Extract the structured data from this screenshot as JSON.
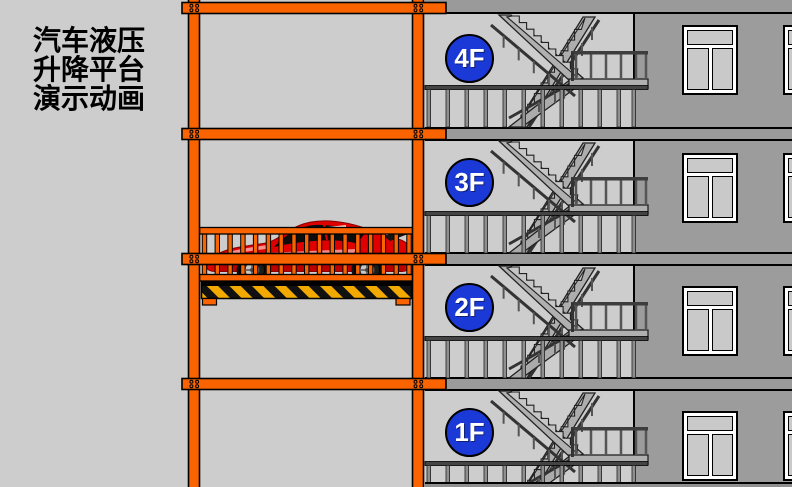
{
  "title": {
    "line1": "汽车液压",
    "line2": "升降平台",
    "line3": "演示动画"
  },
  "floors": [
    {
      "label": "4F"
    },
    {
      "label": "3F"
    },
    {
      "label": "2F"
    },
    {
      "label": "1F"
    }
  ],
  "colors": {
    "frame_orange": "#FA6400",
    "badge_blue": "#1B39D6",
    "car_red": "#DF0000",
    "hazard_yellow": "#F2A900",
    "hazard_black": "#111111",
    "wall_gray": "#9C9C9C",
    "stairwell_gray": "#CDCDCD",
    "slab_gray": "#9A9A9A"
  }
}
